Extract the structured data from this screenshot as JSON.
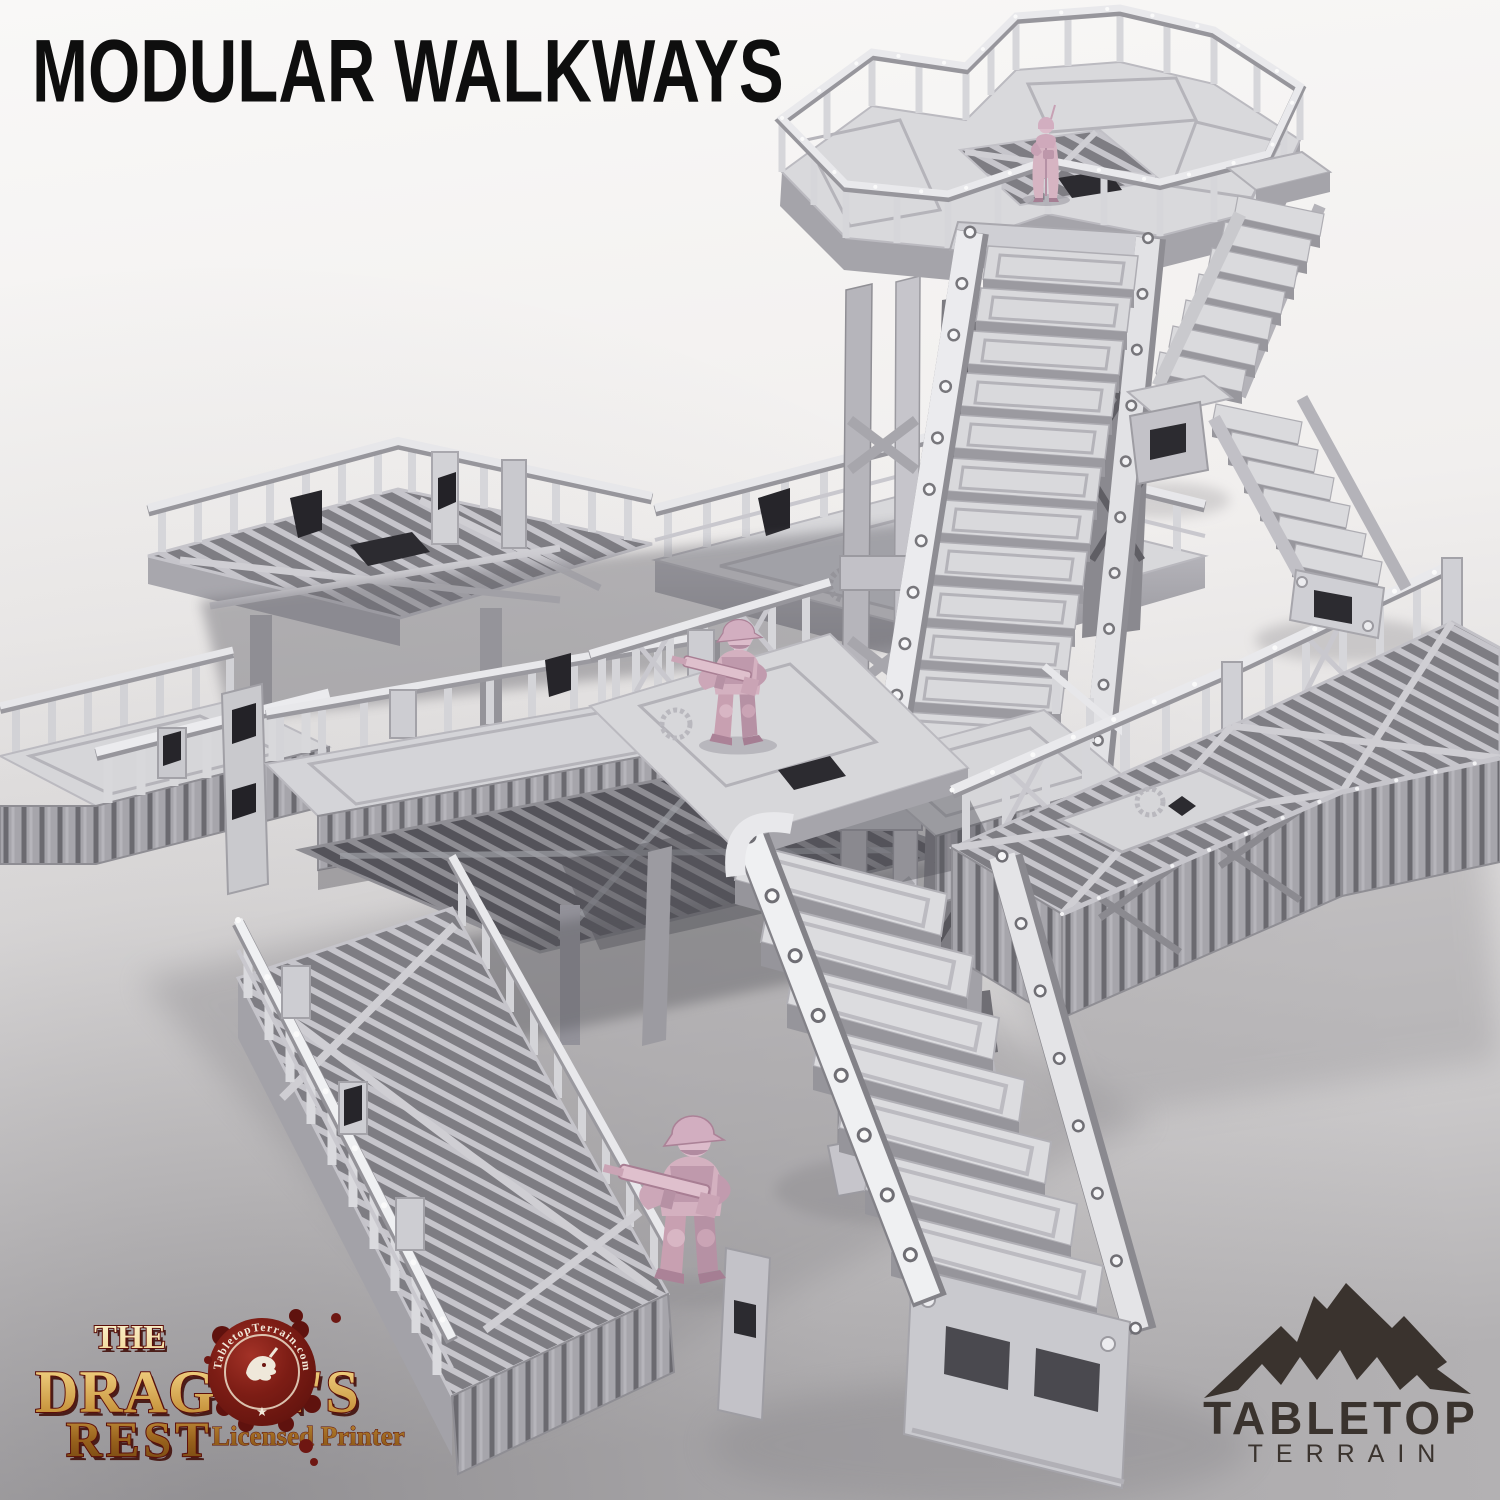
{
  "page": {
    "title": "MODULAR WALKWAYS"
  },
  "branding": {
    "dragons_rest": {
      "the": "THE",
      "dragons": "DRAGON'S",
      "rest": "REST",
      "tagline": "Licensed Printer",
      "seal_text": "TabletopTerrain.com",
      "seal_star": "★"
    },
    "tabletop_terrain": {
      "line1": "TABLETOP",
      "line2": "TERRAIN"
    }
  },
  "scene": {
    "miniature_count": 3,
    "colors": {
      "background_top": "#f9f8f7",
      "background_bottom": "#b3b1b3",
      "terrain_light": "#e9e9ec",
      "terrain_mid": "#d6d6d9",
      "terrain_shadow": "#96959b",
      "slot_dark": "#26252a",
      "miniature_pink": "#d6b4c2",
      "logo_gold": "#ecc979",
      "logo_red": "#6e1712",
      "logo_dark": "#3a332e",
      "title_black": "#0e0e0e"
    }
  }
}
